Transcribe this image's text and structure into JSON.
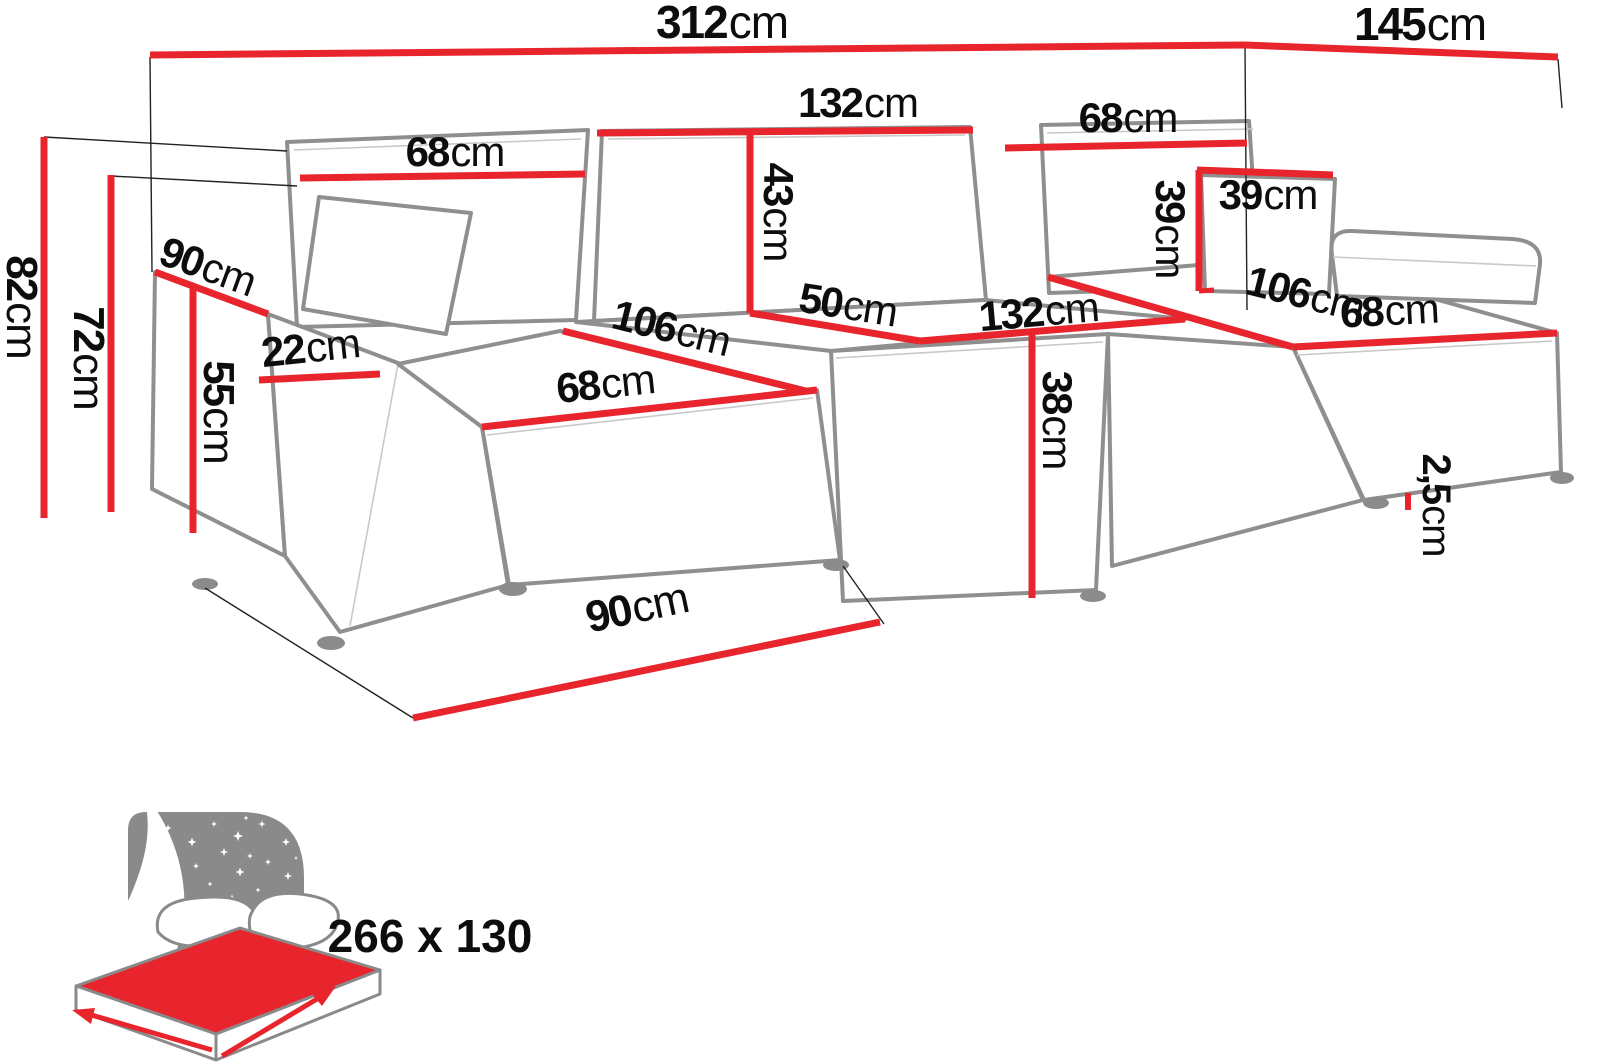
{
  "colors": {
    "dimension_red": "#e8242c",
    "sofa_outline_gray": "#8f8f8f",
    "icon_gray": "#8a8a8a",
    "label_black": "#0d0d0d",
    "background": "#ffffff"
  },
  "dims": [
    {
      "name": "overall-width",
      "v": "312",
      "u": "cm"
    },
    {
      "name": "overall-depth",
      "v": "145",
      "u": "cm"
    },
    {
      "name": "backrest-left-width",
      "v": "68",
      "u": "cm"
    },
    {
      "name": "backrest-mid-width",
      "v": "132",
      "u": "cm"
    },
    {
      "name": "backrest-right-width",
      "v": "68",
      "u": "cm"
    },
    {
      "name": "cushion-width",
      "v": "39",
      "u": "cm"
    },
    {
      "name": "cushion-height",
      "v": "39",
      "u": "cm"
    },
    {
      "name": "backrest-height",
      "v": "43",
      "u": "cm"
    },
    {
      "name": "total-height",
      "v": "82",
      "u": "cm"
    },
    {
      "name": "back-height",
      "v": "72",
      "u": "cm"
    },
    {
      "name": "armrest-height",
      "v": "55",
      "u": "cm"
    },
    {
      "name": "armrest-depth",
      "v": "90",
      "u": "cm"
    },
    {
      "name": "armrest-width",
      "v": "22",
      "u": "cm"
    },
    {
      "name": "chaise-left-length",
      "v": "106",
      "u": "cm"
    },
    {
      "name": "chaise-left-width",
      "v": "68",
      "u": "cm"
    },
    {
      "name": "seat-depth",
      "v": "50",
      "u": "cm"
    },
    {
      "name": "seat-width",
      "v": "132",
      "u": "cm"
    },
    {
      "name": "seat-height",
      "v": "38",
      "u": "cm"
    },
    {
      "name": "chaise-right-length",
      "v": "106",
      "u": "cm"
    },
    {
      "name": "chaise-right-width",
      "v": "68",
      "u": "cm"
    },
    {
      "name": "leg-height",
      "v": "2,5",
      "u": "cm"
    },
    {
      "name": "front-depth",
      "v": "90",
      "u": "cm"
    }
  ],
  "sleeping_area": {
    "label": "266 x 130"
  }
}
